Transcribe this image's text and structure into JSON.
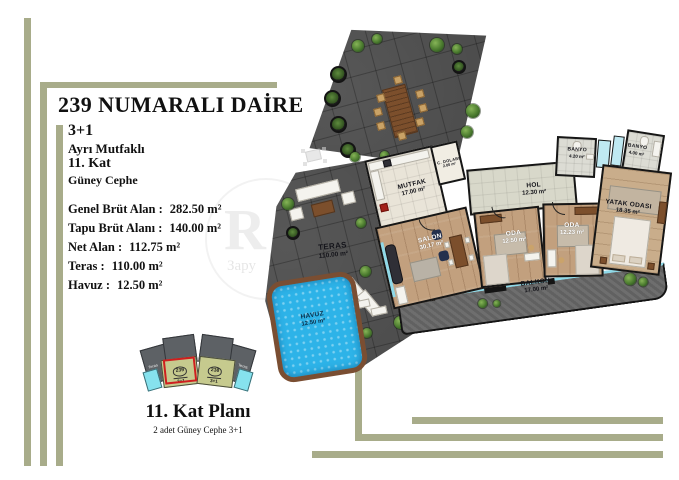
{
  "title": "239 NUMARALI DAİRE",
  "info": {
    "type": "3+1",
    "kitchen": "Ayrı Mutfaklı",
    "floor": "11. Kat",
    "facade": "Güney Cephe"
  },
  "areas": [
    {
      "label": "Genel Brüt Alan :",
      "value": "282.50 m²"
    },
    {
      "label": "Tapu Brüt Alanı :",
      "value": "140.00 m²"
    },
    {
      "label": "Net Alan :",
      "value": "112.75 m²"
    },
    {
      "label": "Teras :",
      "value": "110.00 m²"
    },
    {
      "label": "Havuz :",
      "value": "12.50 m²"
    }
  ],
  "rooms": [
    {
      "name": "MUTFAK",
      "area": "17.00 m²"
    },
    {
      "name": "SALON",
      "area": "30.17 m²"
    },
    {
      "name": "ODA",
      "area": "12.50 m²"
    },
    {
      "name": "ODA",
      "area": "12.23 m²"
    },
    {
      "name": "HOL",
      "area": "12.30 m²"
    },
    {
      "name": "YATAK ODASI",
      "area": "18.35 m²"
    },
    {
      "name": "BANYO",
      "area": "4.20 m²"
    },
    {
      "name": "BANYO",
      "area": "4.00 m²"
    },
    {
      "name": "C. DOLABI",
      "area": "2.00 m²"
    },
    {
      "name": "BALKON",
      "area": "17.00 m²"
    },
    {
      "name": "TERAS",
      "area": "110.00 m²"
    },
    {
      "name": "HAVUZ",
      "area": "12.50 m²"
    }
  ],
  "key_plan": {
    "units": [
      {
        "number": "239",
        "type": "3+1"
      },
      {
        "number": "238",
        "type": "3+1"
      }
    ],
    "teras_label": "Teras"
  },
  "footer": {
    "plan_title": "11. Kat Planı",
    "plan_subtitle": "2 adet Güney Cephe 3+1"
  },
  "watermark": {
    "letter": "R",
    "text": "Зару"
  },
  "colors": {
    "accent": "#a8ac8a",
    "pool": "#2db3e8",
    "highlight": "#cf1f1f",
    "keyplan_band": "#c6ca8e",
    "keyplan_gray": "#5d6165",
    "glass": "#8fd9e8"
  }
}
